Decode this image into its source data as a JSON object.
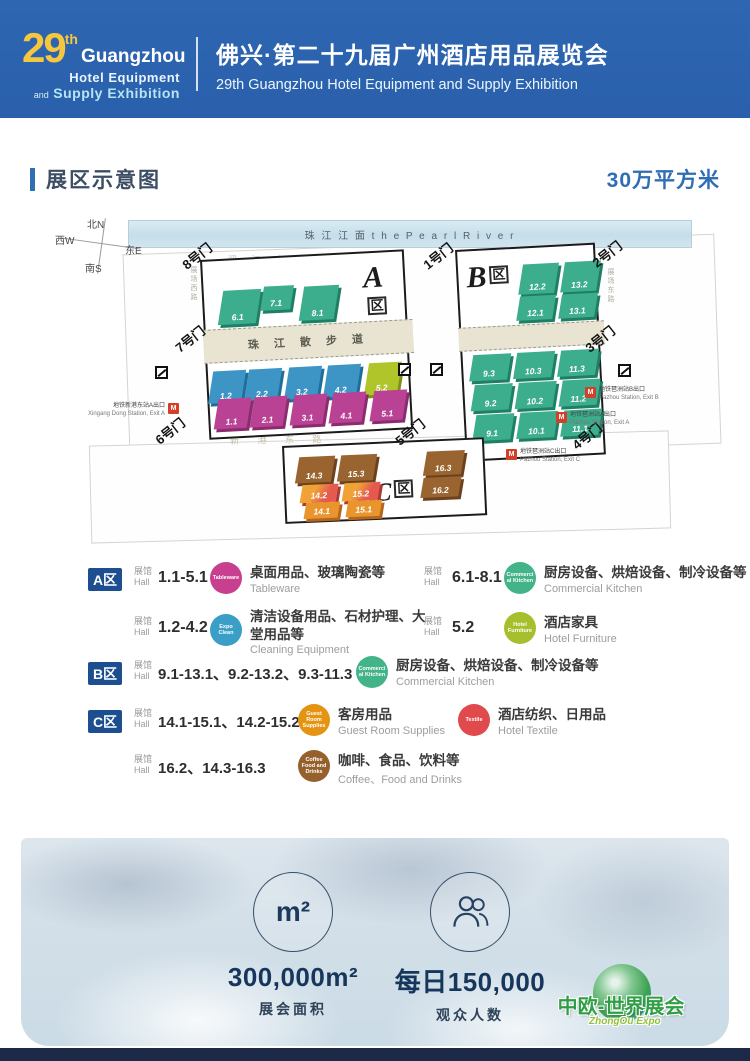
{
  "header": {
    "logo": {
      "number": "29",
      "sup": "th",
      "name": "Guangzhou",
      "line2": "Hotel Equipment",
      "and": "and",
      "line3": "Supply Exhibition"
    },
    "title_zh": "佛兴·第二十九届广州酒店用品展览会",
    "title_en": "29th Guangzhou Hotel Equipment and Supply Exhibition"
  },
  "section": {
    "title": "展区示意图",
    "area": "30万平方米"
  },
  "map": {
    "compass": {
      "n": "北N",
      "w": "西W",
      "e": "东E",
      "s": "南S"
    },
    "river": "珠 江 江 面   t h e   P e a r l   R i v e r",
    "roads": {
      "yuejiang_zh": "阅 江 中 路",
      "yuejiang_en": "Yuejiang Mid Road",
      "walkway": "珠 江 散 步 道",
      "xingang": "新 港 东 路",
      "west": "展场西路",
      "mid": "展场中路",
      "east": "展场东路"
    },
    "gates": {
      "g1": "1号门",
      "g2": "2号门",
      "g3": "3号门",
      "g4": "4号门",
      "g5": "5号门",
      "g6": "6号门",
      "g7": "7号门",
      "g8": "8号门"
    },
    "zones": {
      "a": "A",
      "b": "B",
      "c": "C",
      "qu": "区"
    },
    "halls": {
      "h61": "6.1",
      "h71": "7.1",
      "h81": "8.1",
      "h122": "12.2",
      "h132": "13.2",
      "h121": "12.1",
      "h131": "13.1",
      "h12": "1.2",
      "h22": "2.2",
      "h32": "3.2",
      "h42": "4.2",
      "h52": "5.2",
      "h11": "1.1",
      "h21": "2.1",
      "h31": "3.1",
      "h41": "4.1",
      "h51": "5.1",
      "h93": "9.3",
      "h103": "10.3",
      "h113": "11.3",
      "h92": "9.2",
      "h102": "10.2",
      "h112": "11.2",
      "h91": "9.1",
      "h101": "10.1",
      "h111": "11.1",
      "h143": "14.3",
      "h153": "15.3",
      "h142": "14.2",
      "h152": "15.2",
      "h141": "14.1",
      "h151": "15.1",
      "h163": "16.3",
      "h162": "16.2"
    },
    "metro": {
      "m_label": "M",
      "xa_zh": "地铁新港东站A出口",
      "xa_en": "Xingang Dong Station, Exit A",
      "pb_zh": "地铁琶洲站B出口",
      "pb_en": "Pazhou Station, Exit B",
      "pa_zh": "地铁琶洲站A出口",
      "pa_en": "Pazhou Station, Exit A",
      "pc_zh": "地铁琶洲站C出口",
      "pc_en": "Pazhou Station, Exit C"
    }
  },
  "legend": {
    "hall_zh": "展馆",
    "hall_en": "Hall",
    "zoneA": "A区",
    "zoneB": "B区",
    "zoneC": "C区",
    "rows": {
      "a1": {
        "range": "1.1-5.1",
        "icon": "Tableware",
        "zh": "桌面用品、玻璃陶瓷等",
        "en": "Tableware"
      },
      "a1b": {
        "range": "6.1-8.1",
        "icon": "Commercial Kitchen",
        "zh": "厨房设备、烘焙设备、制冷设备等",
        "en": "Commercial Kitchen"
      },
      "a2": {
        "range": "1.2-4.2",
        "icon": "Expo Clean",
        "zh": "清洁设备用品、石材护理、大堂用品等",
        "en": "Cleaning Equipment"
      },
      "a2b": {
        "range": "5.2",
        "icon": "Hotel Furniture",
        "zh": "酒店家具",
        "en": "Hotel Furniture"
      },
      "b1": {
        "range": "9.1-13.1、9.2-13.2、9.3-11.3",
        "icon": "Commercial Kitchen",
        "zh": "厨房设备、烘焙设备、制冷设备等",
        "en": "Commercial Kitchen"
      },
      "c1": {
        "range": "14.1-15.1、14.2-15.2",
        "icon": "Guest Room Supplies",
        "zh": "客房用品",
        "en": "Guest Room Supplies"
      },
      "c1b": {
        "icon": "Textile",
        "zh": "酒店纺织、日用品",
        "en": "Hotel Textile"
      },
      "c2": {
        "range": "16.2、14.3-16.3",
        "icon": "Coffee Food and Drinks",
        "zh": "咖啡、食品、饮料等",
        "en": "Coffee、Food and Drinks"
      }
    }
  },
  "stats": {
    "m2": "m²",
    "area_value": "300,000m²",
    "area_label": "展会面积",
    "visitors_value": "每日150,000",
    "visitors_label": "观众人数"
  },
  "footer_logo": {
    "zh": "中欧-世界展会",
    "en": "ZhongOu Expo"
  }
}
